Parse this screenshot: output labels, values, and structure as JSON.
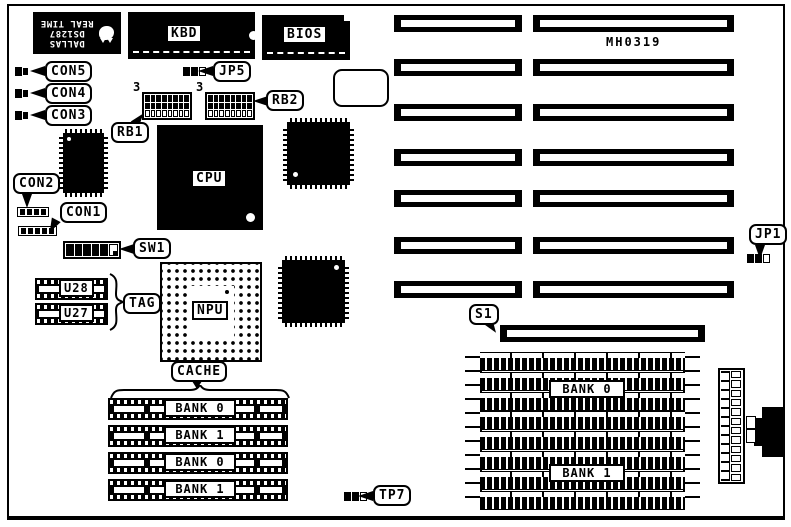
{
  "board": {
    "id": "MH0319",
    "colors": {
      "ink": "#000000",
      "paper": "#ffffff"
    }
  },
  "chips": {
    "rtc": {
      "brand": "DALLAS",
      "model": "DS1287",
      "line": "REAL TIME"
    },
    "kbd": "KBD",
    "bios": "BIOS",
    "cpu": "CPU",
    "npu": "NPU",
    "u28": "U28",
    "u27": "U27"
  },
  "callouts": {
    "con5": "CON5",
    "con4": "CON4",
    "con3": "CON3",
    "con2": "CON2",
    "con1": "CON1",
    "jp5": "JP5",
    "rb1": "RB1",
    "rb2": "RB2",
    "sw1": "SW1",
    "tag": "TAG",
    "cache": "CACHE",
    "s1": "S1",
    "jp1": "JP1",
    "tp7": "TP7"
  },
  "markers": {
    "rb1_pin": "3",
    "rb2_pin": "3"
  },
  "cache_banks": [
    "BANK 0",
    "BANK 1",
    "BANK 0",
    "BANK 1"
  ],
  "simm_banks": [
    "BANK 0",
    "BANK 1"
  ]
}
